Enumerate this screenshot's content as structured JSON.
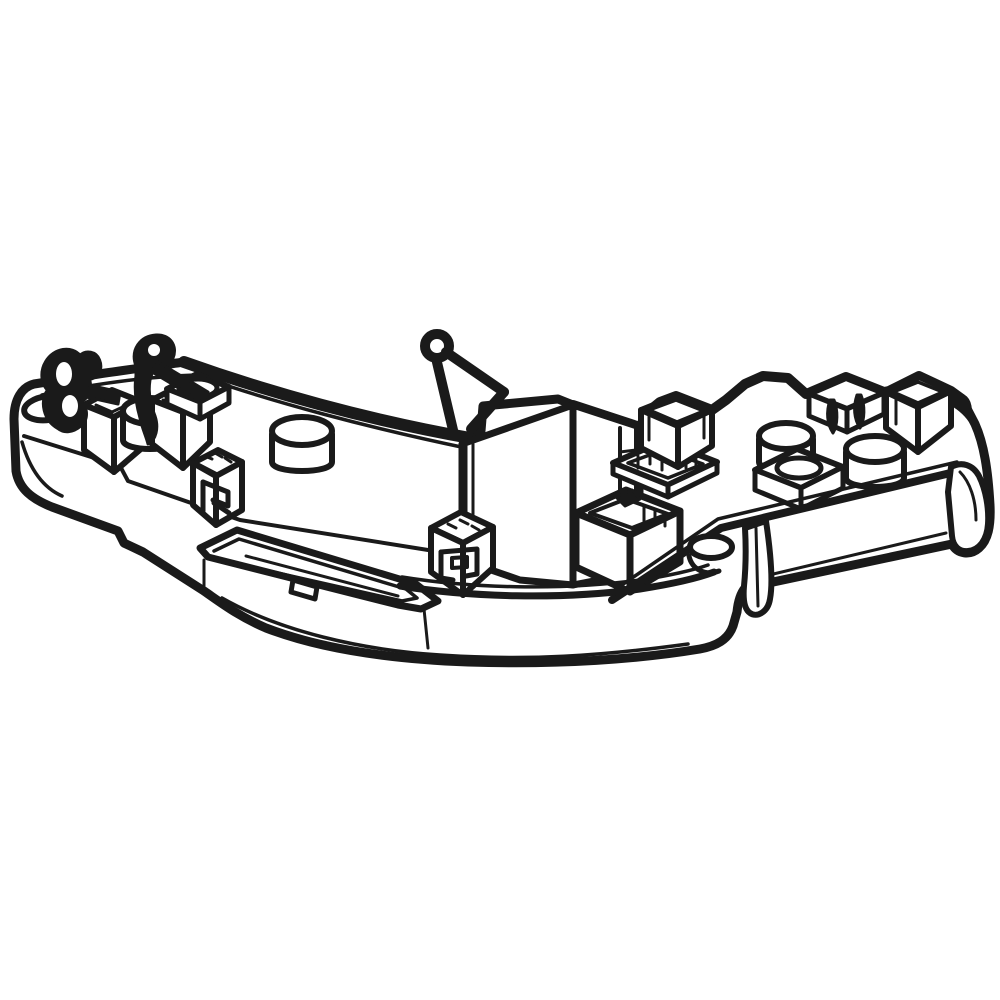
{
  "theme": {
    "paper": "#ffffff",
    "line": "#1a1a1a"
  },
  "figure": {
    "subject": "Isometric technical line drawing of a curved plastic mounting base plate with snap clips, square sockets, keyed sockets and cylindrical bosses",
    "style": "black contour line art on white background, no shading, no text, no dimensions",
    "parts": [
      "base-plate",
      "loop-clip",
      "snap-hook",
      "pin-clip",
      "oval-opening-left",
      "square-post-left-front",
      "square-post-left-rear",
      "round-boss-small",
      "raised-pad-with-oval-opening",
      "round-boss-left",
      "keyed-socket-left",
      "cable-trough",
      "trough-notch",
      "divider-wall",
      "keyed-socket-center",
      "square-socket-center",
      "ribbed-socket",
      "ladder-column",
      "back-post",
      "clip-finger-socket",
      "back-post-right",
      "corner-hook",
      "round-boss-right-front",
      "round-boss-right-rear",
      "oval-pad-right",
      "screw-lug",
      "snap-clip-center",
      "snap-clip-right"
    ]
  }
}
